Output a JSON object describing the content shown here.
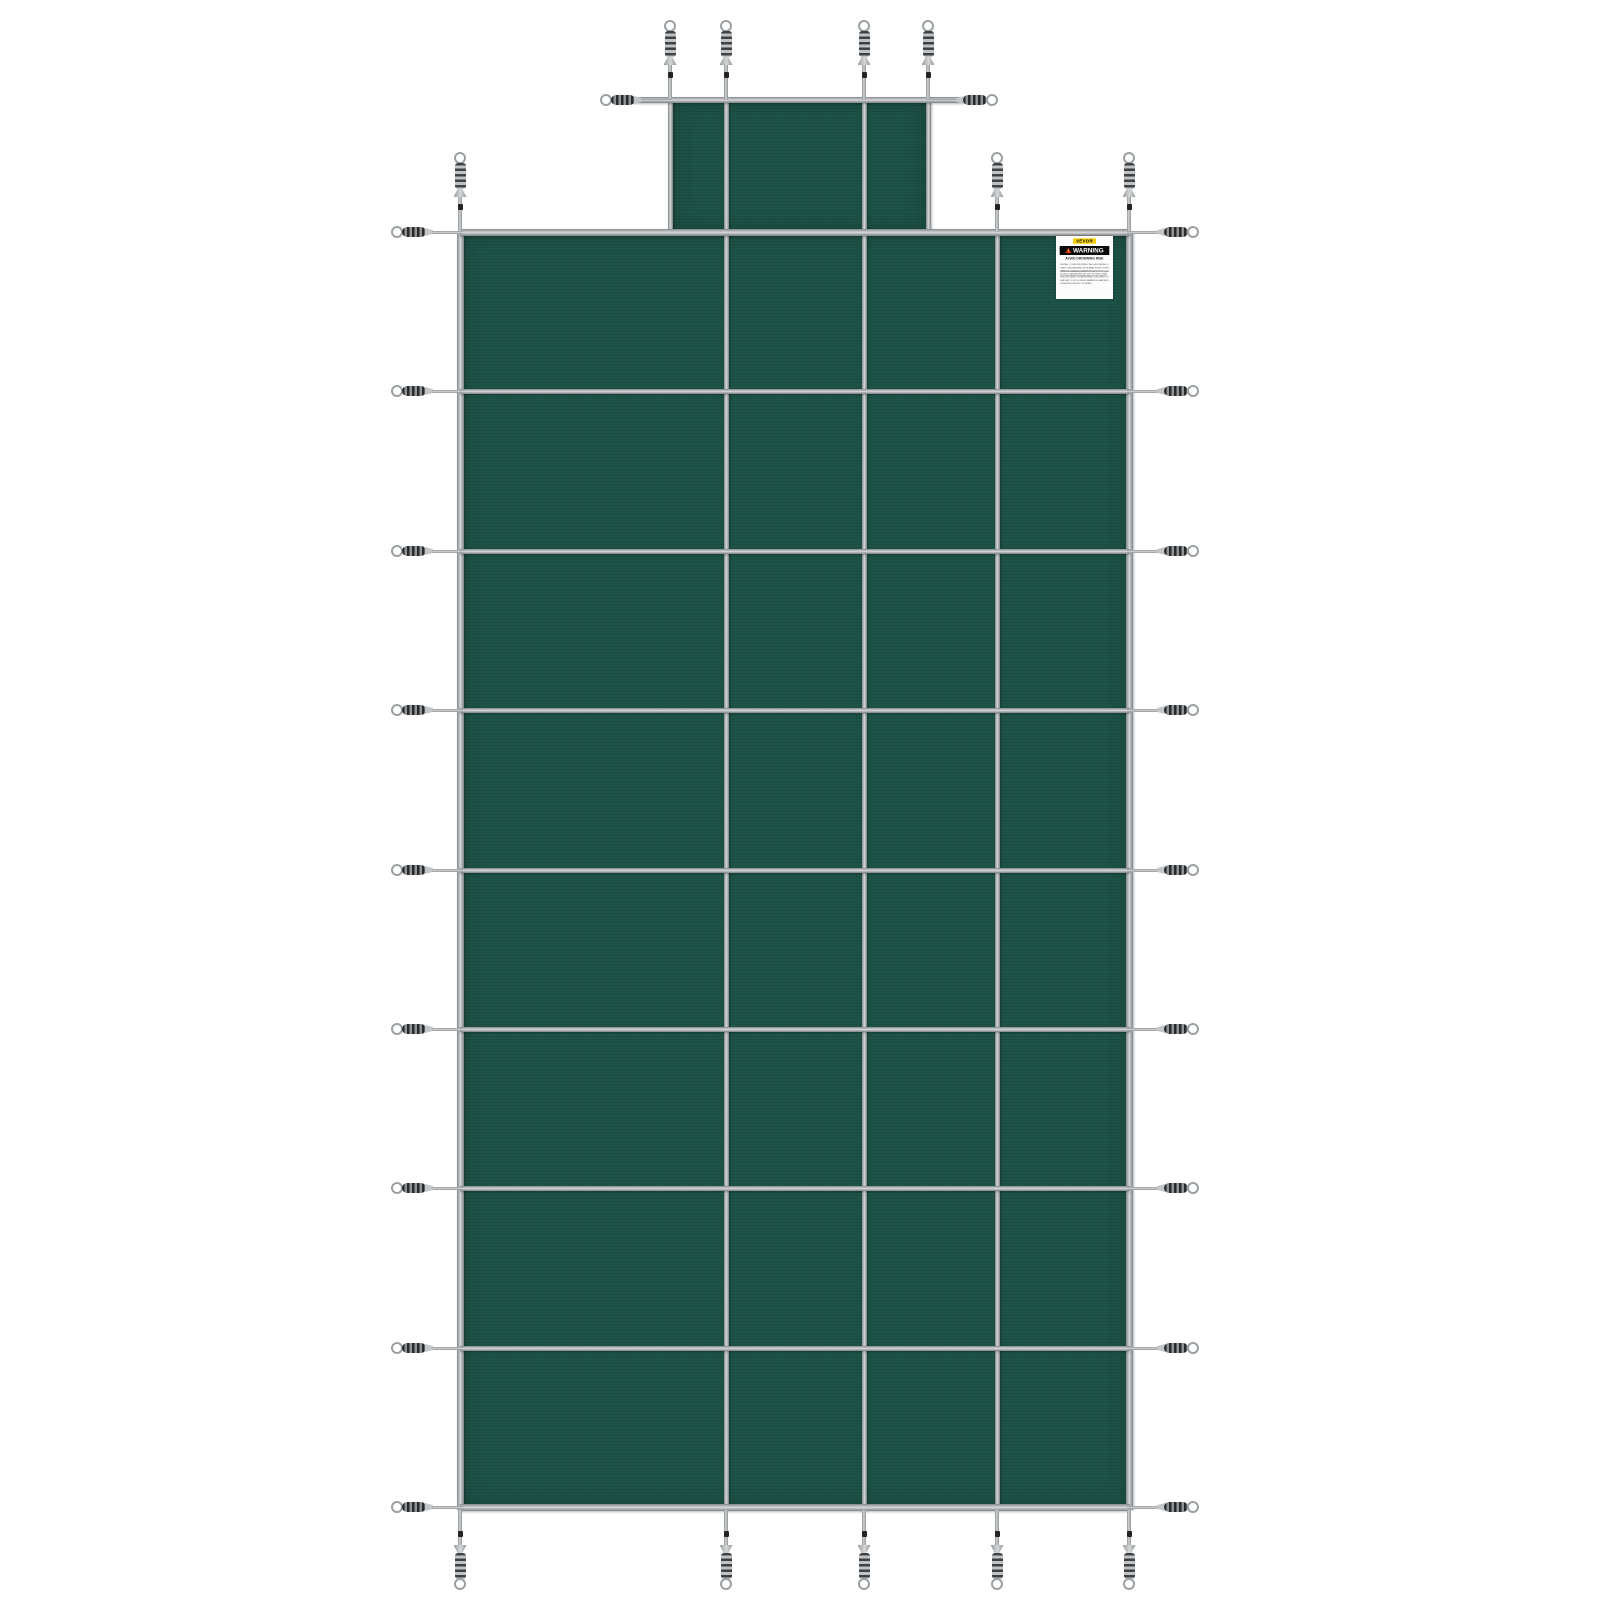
{
  "product": {
    "name": "Green mesh inground pool safety cover with center step extension",
    "colors": {
      "mesh_green": "#1e5449",
      "strap_gray": "#b9bcbe",
      "spring_coil_dark": "#28292b",
      "background": "#ffffff",
      "label_yellow": "#f6cf00",
      "label_red": "#e03800"
    }
  },
  "warning_label": {
    "brand": "VEVOR",
    "title": "WARNING",
    "subtitle": "AVOID DROWNING RISK",
    "lines": [
      {
        "text": "INSTALL COVER PROPERLY AND SECURE ALL SPRINGS BEFORE USE",
        "u": false
      },
      {
        "text": "KEEP CHILDREN AND PETS AWAY FROM COVER",
        "u": false
      },
      {
        "text": "REMOVE STANDING WATER FROM TOP OF COVER",
        "u": true
      },
      {
        "text": "A CHILD CAN DROWN ON TOP OF THE COVER",
        "u": true
      },
      {
        "text": "NON-SECURED OR IMPROPERLY SECURED COVERS ARE A HAZARD",
        "u": false
      },
      {
        "text": "FAILURE TO FOLLOW ALL WARNINGS MAY RESULT",
        "u": false
      },
      {
        "text": "IN SERIOUS INJURY OR DEATH",
        "u": false
      }
    ],
    "position": {
      "x": 1056,
      "y": 236,
      "width": 57,
      "height": 63
    }
  },
  "figure": {
    "canvas": {
      "width": 1600,
      "height": 1600
    },
    "main_panel": {
      "x": 460,
      "y": 232,
      "width": 670,
      "height": 1276
    },
    "step_panel": {
      "x": 670,
      "y": 100,
      "width": 258,
      "height": 132
    },
    "vertical_straps": [
      [
        460,
        232,
        1510,
        7
      ],
      [
        670,
        100,
        232,
        5
      ],
      [
        726,
        100,
        1510,
        5
      ],
      [
        864,
        100,
        1510,
        5
      ],
      [
        928,
        100,
        232,
        5
      ],
      [
        997,
        232,
        1510,
        5
      ],
      [
        1129,
        232,
        1510,
        7
      ]
    ],
    "horizontal_straps": [
      [
        100,
        634,
        964,
        6
      ],
      [
        232,
        460,
        1130,
        7
      ],
      [
        391,
        460,
        1130,
        5
      ],
      [
        551,
        460,
        1130,
        5
      ],
      [
        710,
        460,
        1130,
        5
      ],
      [
        870,
        460,
        1130,
        5
      ],
      [
        1029,
        460,
        1130,
        5
      ],
      [
        1188,
        460,
        1130,
        5
      ],
      [
        1348,
        460,
        1130,
        5
      ],
      [
        1507,
        460,
        1130,
        7
      ]
    ],
    "springs_up": [
      [
        670,
        100
      ],
      [
        726,
        100
      ],
      [
        864,
        100
      ],
      [
        928,
        100
      ],
      [
        460,
        232
      ],
      [
        997,
        232
      ],
      [
        1129,
        232
      ]
    ],
    "springs_down": [
      [
        460,
        1510
      ],
      [
        726,
        1510
      ],
      [
        864,
        1510
      ],
      [
        997,
        1510
      ],
      [
        1129,
        1510
      ]
    ],
    "springs_left": [
      [
        672,
        100
      ],
      [
        463,
        232
      ],
      [
        463,
        391
      ],
      [
        463,
        551
      ],
      [
        463,
        710
      ],
      [
        463,
        870
      ],
      [
        463,
        1029
      ],
      [
        463,
        1188
      ],
      [
        463,
        1348
      ],
      [
        463,
        1507
      ]
    ],
    "springs_right": [
      [
        926,
        100
      ],
      [
        1127,
        232
      ],
      [
        1127,
        391
      ],
      [
        1127,
        551
      ],
      [
        1127,
        710
      ],
      [
        1127,
        870
      ],
      [
        1127,
        1029
      ],
      [
        1127,
        1188
      ],
      [
        1127,
        1348
      ],
      [
        1127,
        1507
      ]
    ]
  }
}
